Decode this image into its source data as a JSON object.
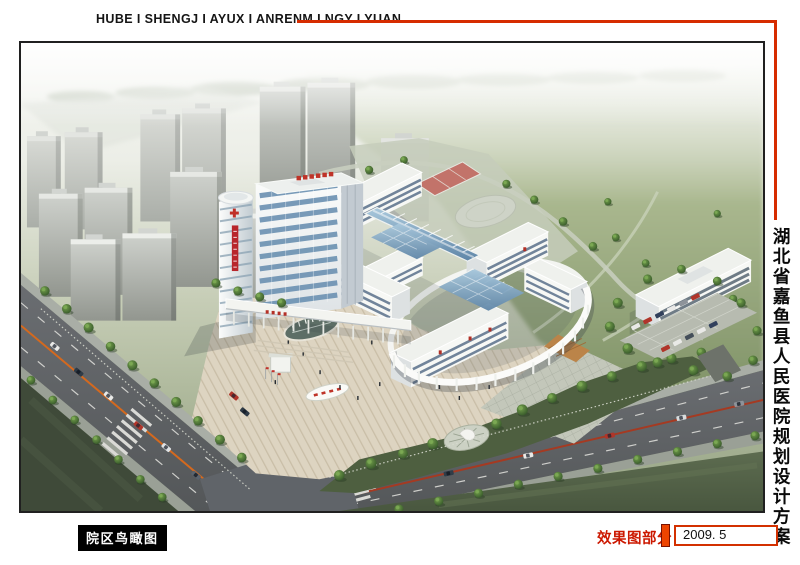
{
  "header": {
    "title": "HUBE I SHENGJ I AYUX I ANRENM I NGY I YUAN",
    "accent_color": "#d62c00"
  },
  "side_title": {
    "text": "湖北省嘉鱼县人民医院规划设计方案"
  },
  "footer": {
    "caption_label": "院区鸟瞰图",
    "section_label": "效果图部分",
    "date": "2009. 5"
  },
  "colors": {
    "accent_red": "#d62c00",
    "caption_bg": "#000000",
    "caption_fg": "#ffffff",
    "section_label_color": "#cc1800"
  }
}
